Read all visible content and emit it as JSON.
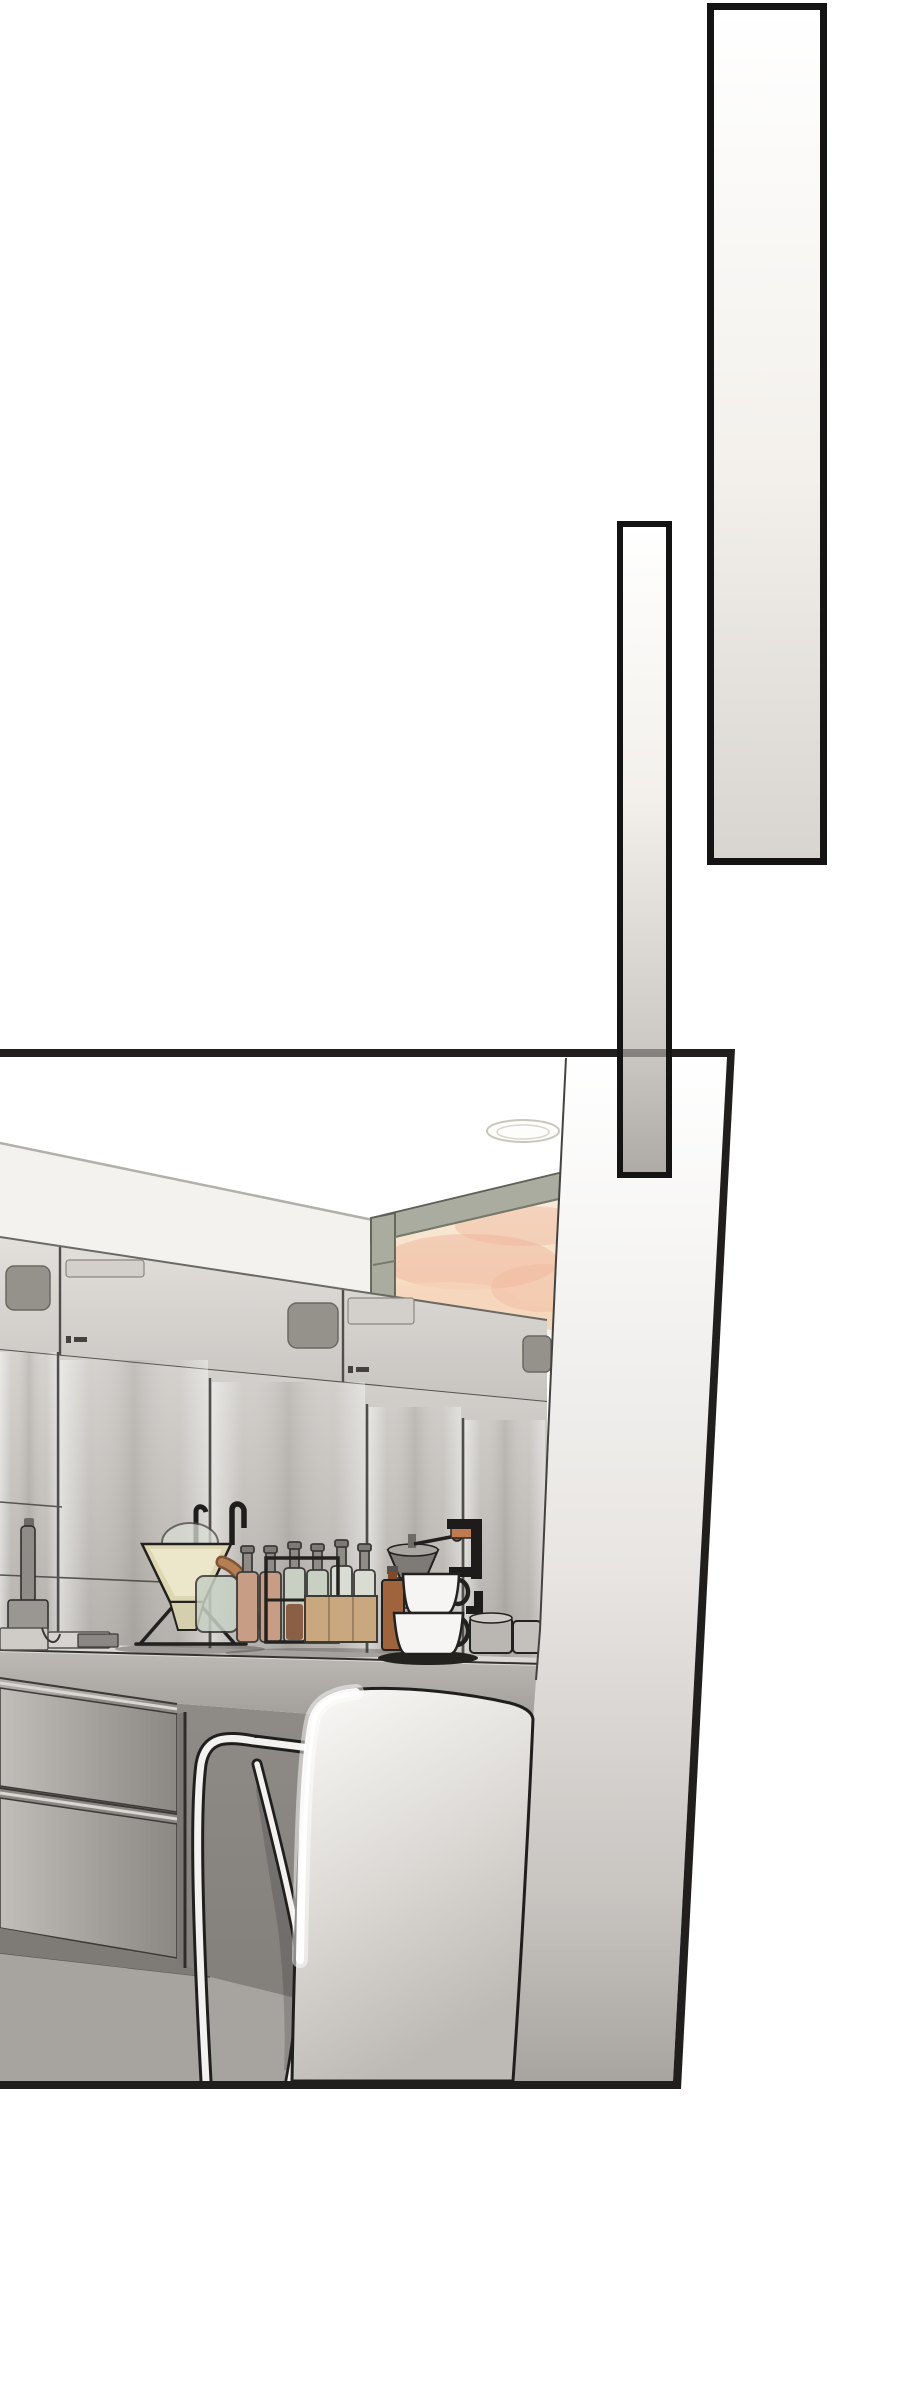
{
  "page": {
    "kind": "webtoon page segment",
    "width_px": 900,
    "height_px": 2381,
    "text_content": "none (wordless art panel)"
  },
  "decor_bars": {
    "count": 2,
    "large_bar": {
      "role": "vertical accent panel",
      "gradient": "white to warm gray"
    },
    "small_bar": {
      "role": "vertical accent panel overlapping kitchen panel",
      "gradient": "white to gray"
    }
  },
  "panel": {
    "name": "cafe-kitchen-panel",
    "depicts": [
      "ceiling lamp ellipse",
      "ceiling-wall junction line",
      "sunset pass-through window",
      "stainless steel cabinet wall with recessed handles and vents",
      "coffee counter with dripper stand, glass dome, copper kettle spout, carafe",
      "row of spray bottles",
      "black wire rack",
      "wooden box",
      "hand coffee grinder with crank",
      "amber bottle",
      "stacked white cups on black saucer",
      "gray mugs",
      "under-counter drawer unit",
      "bentwood cafe chair (tubular legs)",
      "large white pitcher-like foreground object",
      "near wall in perspective on right"
    ]
  },
  "colors": {
    "page_bg": "#ffffff",
    "ink": "#211f1e",
    "bar_border": "#141414",
    "bar_top": "#ffffff",
    "bar_mid": "#f3f0eb",
    "bar_large_bottom": "#d8d5d0",
    "bar_small_low": "#cdc9c5",
    "bar_small_bottom": "#aeaaa6",
    "ceiling_line": "#b2b0ab",
    "wall": "#f4f2ee",
    "window_frame": "#a9ac9f",
    "window_frame_dark": "#767a6c",
    "sky_top": "#f9eedd",
    "sky_bottom": "#f4d3b6",
    "cloud_pink": "#efb69c",
    "cloud_peach": "#f6d6bd",
    "steel_light": "#e3e0dc",
    "steel_mid": "#c7c4c0",
    "door_light": "#d6d3cf",
    "door_dark": "#b2aeaa",
    "handle": "#95918b",
    "vent": "#d3d0cb",
    "counter_top": "#dcd9d5",
    "counter_front": "#bdb9b5",
    "counter_front_dark": "#9c9894",
    "under_counter": "#8f8b87",
    "under_counter_dark": "#807c78",
    "floor": "#a7a39f",
    "drawer_light": "#c1bdb9",
    "drawer_dark": "#8b8783",
    "near_wall_top": "#ffffff",
    "near_wall_mid": "#e8e5e2",
    "near_wall_low": "#c8c5c1",
    "near_wall_bottom": "#a8a4a0",
    "boundary_line": "#45433f",
    "object_light": "#fbfaf8",
    "object_mid": "#dcd9d5",
    "object_dark": "#bdb9b5",
    "chair_tube": "#f3f2f0",
    "funnel_cream": "#ded7b3",
    "funnel_cream_light": "#efe9cf",
    "copper": "#b57e52",
    "copper_dark": "#7d5434",
    "glass_green": "#c7d0c3",
    "liquid_tan": "#c79d85",
    "liquid_brown": "#8a5f46",
    "amber": "#a0643c",
    "wood_tan": "#c9a87f",
    "cup_white": "#f6f5f3",
    "mug_gray": "#bab6b2",
    "saucer_black": "#23221f",
    "rack_black": "#232220",
    "shadow": "#55524e"
  }
}
